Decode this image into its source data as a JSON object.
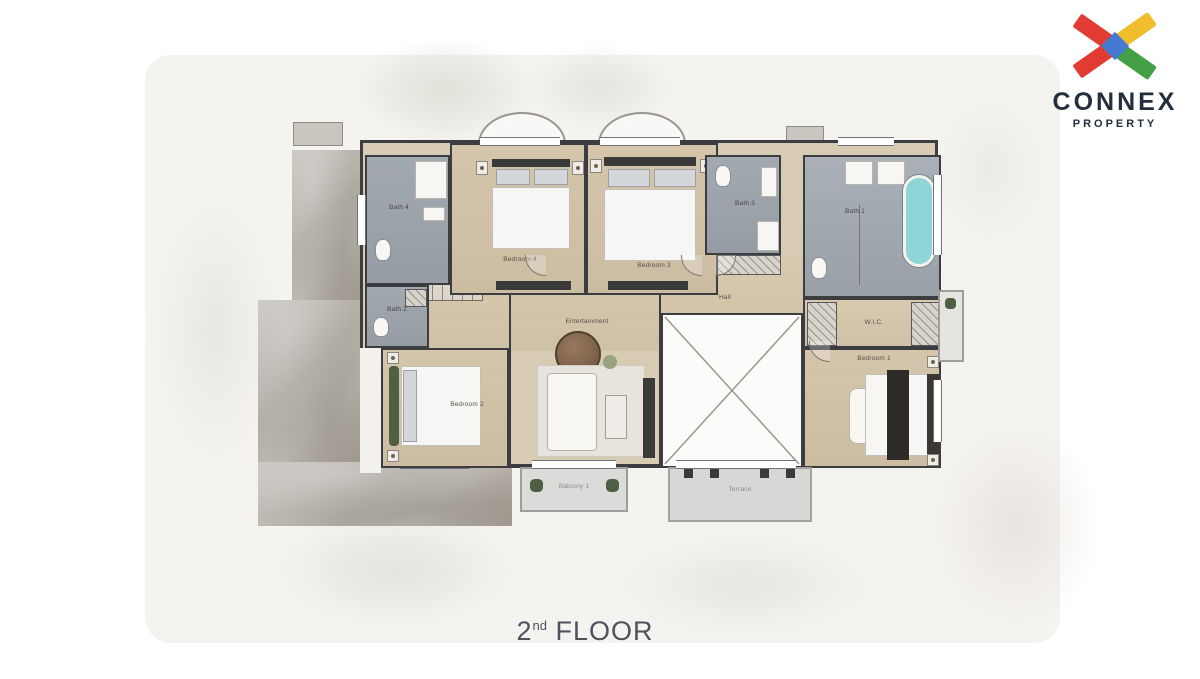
{
  "page": {
    "caption": {
      "number": "2",
      "ordinal": "nd",
      "word": "FLOOR"
    }
  },
  "logo": {
    "brand": "CONNEX",
    "tagline": "PROPERTY",
    "colors": {
      "red": "#e23b33",
      "yellow": "#f0bd2d",
      "green": "#43a047",
      "blue": "#4679d2",
      "navy": "#232f3e"
    }
  },
  "plan": {
    "labels": {
      "bath4": "Bath 4",
      "bedroom4": "Bedroom 4",
      "bedroom3": "Bedroom 3",
      "bath3": "Bath 3",
      "master_bath": "Bath 1",
      "wic": "W.I.C.",
      "hall": "Hall",
      "bath2": "Bath 2",
      "bedroom2": "Bedroom 2",
      "entertainment": "Entertainment",
      "master_bedroom": "Bedroom 1",
      "balcony": "Balcony 1",
      "terrace": "Terrace"
    },
    "colors": {
      "floor_wood": "#d2c3a9",
      "bath_tile": "#9ba1a9",
      "wall": "#3b3d41",
      "bathtub": "#8ed4d8",
      "roof_watercolor": "#b2aea6",
      "backdrop": "#f4f3f0",
      "balcony_gray": "#dbdbd9"
    }
  }
}
